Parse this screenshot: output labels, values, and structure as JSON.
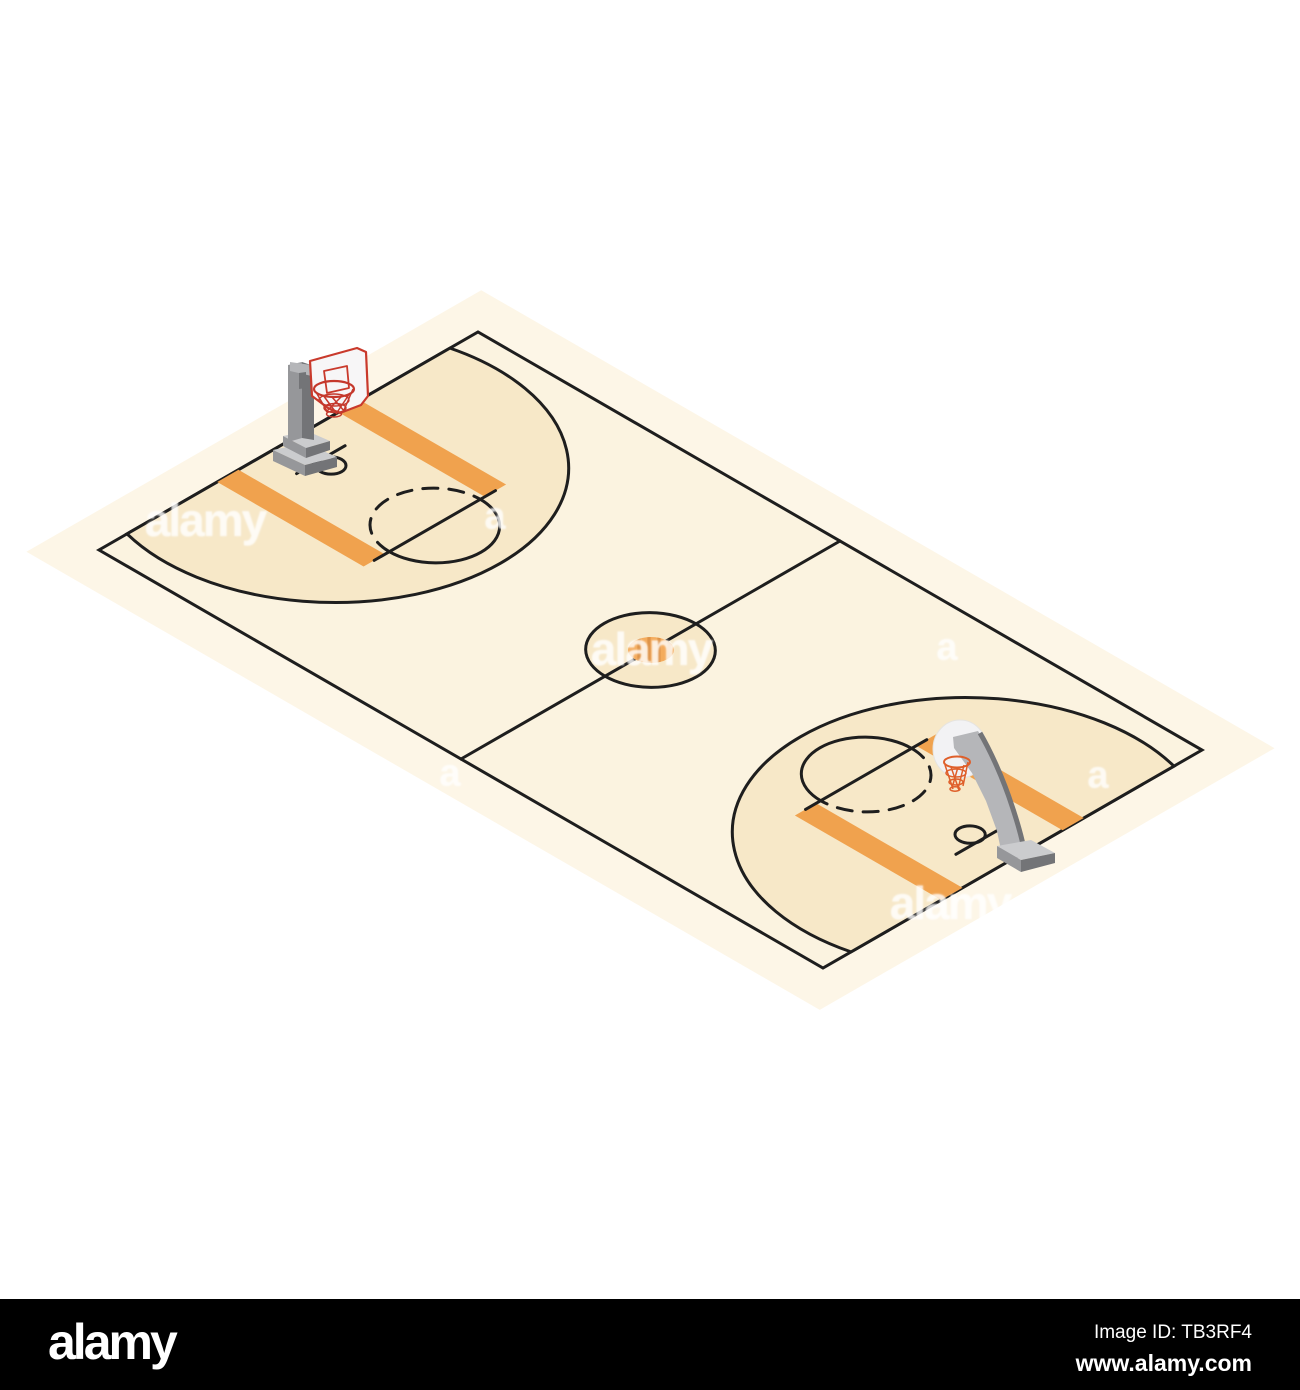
{
  "colors": {
    "background": "#ffffff",
    "shadow": "#fdf6e7",
    "court": "#fbf3e0",
    "zone": "#f7e8c8",
    "stripe": "#f0a24e",
    "line": "#1e1e1e",
    "ball": "#f4ab5c",
    "ball_stripe": "#de9348",
    "board_white": "#f7f6f7",
    "board_red": "#c93a2c",
    "net_red": "#c5382c",
    "net_orange": "#df5f2a",
    "board_circle": "#f2f2f4",
    "pole_top": "#cbccce",
    "pole_light": "#b5b6b9",
    "pole_mid": "#96979a",
    "pole_dark": "#737477",
    "footer_bg": "#000000",
    "footer_text": "#ffffff"
  },
  "watermarks": {
    "logo_text": "alamy",
    "letter_text": "a"
  },
  "footer": {
    "logo_text": "alamy",
    "image_id": "Image ID: TB3RF4",
    "website": "www.alamy.com"
  }
}
